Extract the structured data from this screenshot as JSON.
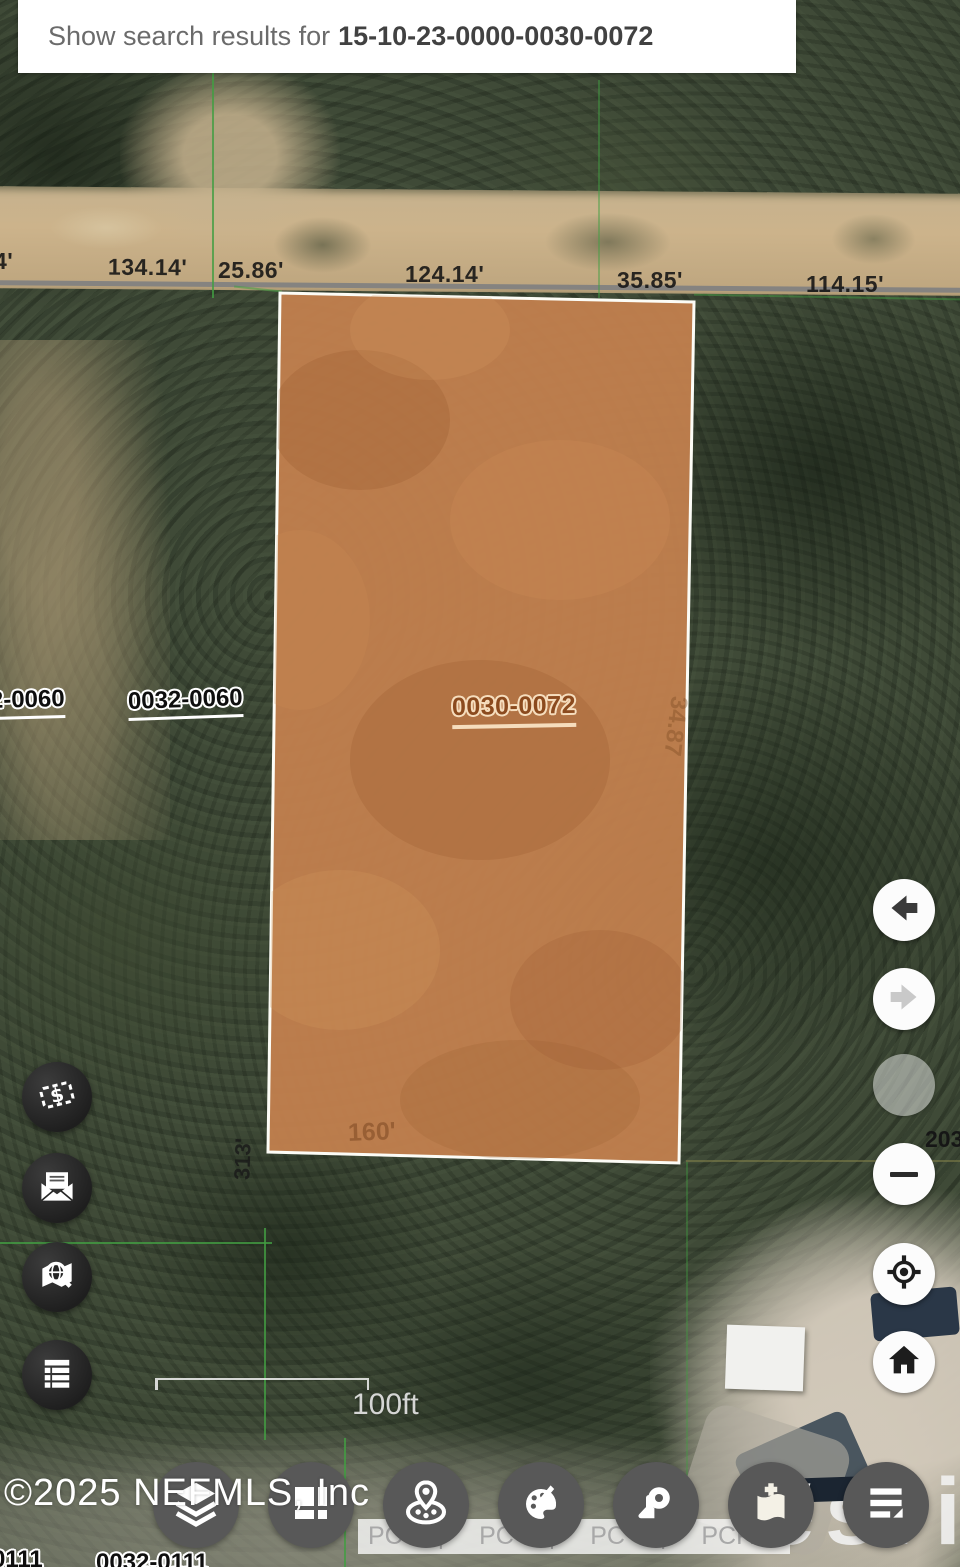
{
  "banner": {
    "prefix": "Show search results for",
    "parcel_id": "15-10-23-0000-0030-0072"
  },
  "map": {
    "road_dimension_labels": [
      "4'",
      "134.14'",
      "25.86'",
      "124.14'",
      "35.85'",
      "114.15'"
    ],
    "parcel_labels": {
      "selected": "0030-0072",
      "neighbor_left_full": "0032-0060",
      "neighbor_left_partial": "2-0060",
      "bottom_left_partial": "0111",
      "bottom_left_full": "0032-0111",
      "right_edge_partial": "203"
    },
    "inline_dimensions": {
      "parcel_right_vertical": "34.87",
      "west_boundary_vertical": "313'",
      "parcel_bottom": "160'"
    },
    "scale_bar_label": "100ft",
    "watermark": "©2025 NEFMLS, Inc",
    "attribution_text": "PC | PC | PC | PCPA",
    "powered_by_fragment": "POW",
    "esri_logo_text": "esri",
    "colors": {
      "selected_parcel_fill": "#c5814f",
      "selected_parcel_border": "#ffffff",
      "boundary_line_green": "#42a142",
      "road_line_gray": "#808080",
      "label_halo": "#ffffff",
      "selected_label_text": "#8b4a1e",
      "selected_label_halo": "#f6ddbd"
    }
  },
  "left_toolbar": {
    "items": [
      {
        "name": "sales",
        "icon": "price-tag-dollar-icon"
      },
      {
        "name": "mailing-labels",
        "icon": "mail-envelope-icon"
      },
      {
        "name": "map-search",
        "icon": "map-search-icon"
      },
      {
        "name": "results-list",
        "icon": "table-list-icon"
      }
    ]
  },
  "right_toolbar": {
    "items": [
      {
        "name": "back",
        "icon": "back-arrow-icon",
        "enabled": true
      },
      {
        "name": "forward",
        "icon": "forward-arrow-icon",
        "enabled": false
      },
      {
        "name": "zoom-in",
        "icon": "zoom-in-icon",
        "enabled": false
      },
      {
        "name": "zoom-out",
        "icon": "minus-icon",
        "enabled": true
      },
      {
        "name": "my-location",
        "icon": "crosshair-locate-icon",
        "enabled": true
      },
      {
        "name": "home-extent",
        "icon": "home-icon",
        "enabled": true
      }
    ]
  },
  "bottom_toolbar": {
    "items": [
      {
        "name": "layers",
        "icon": "layers-icon"
      },
      {
        "name": "basemap",
        "icon": "basemap-grid-icon"
      },
      {
        "name": "locations",
        "icon": "map-pin-group-icon"
      },
      {
        "name": "theme",
        "icon": "palette-icon"
      },
      {
        "name": "measure",
        "icon": "measure-tape-icon"
      },
      {
        "name": "bookmarks",
        "icon": "flag-add-icon"
      },
      {
        "name": "legend",
        "icon": "legend-list-icon"
      }
    ]
  }
}
